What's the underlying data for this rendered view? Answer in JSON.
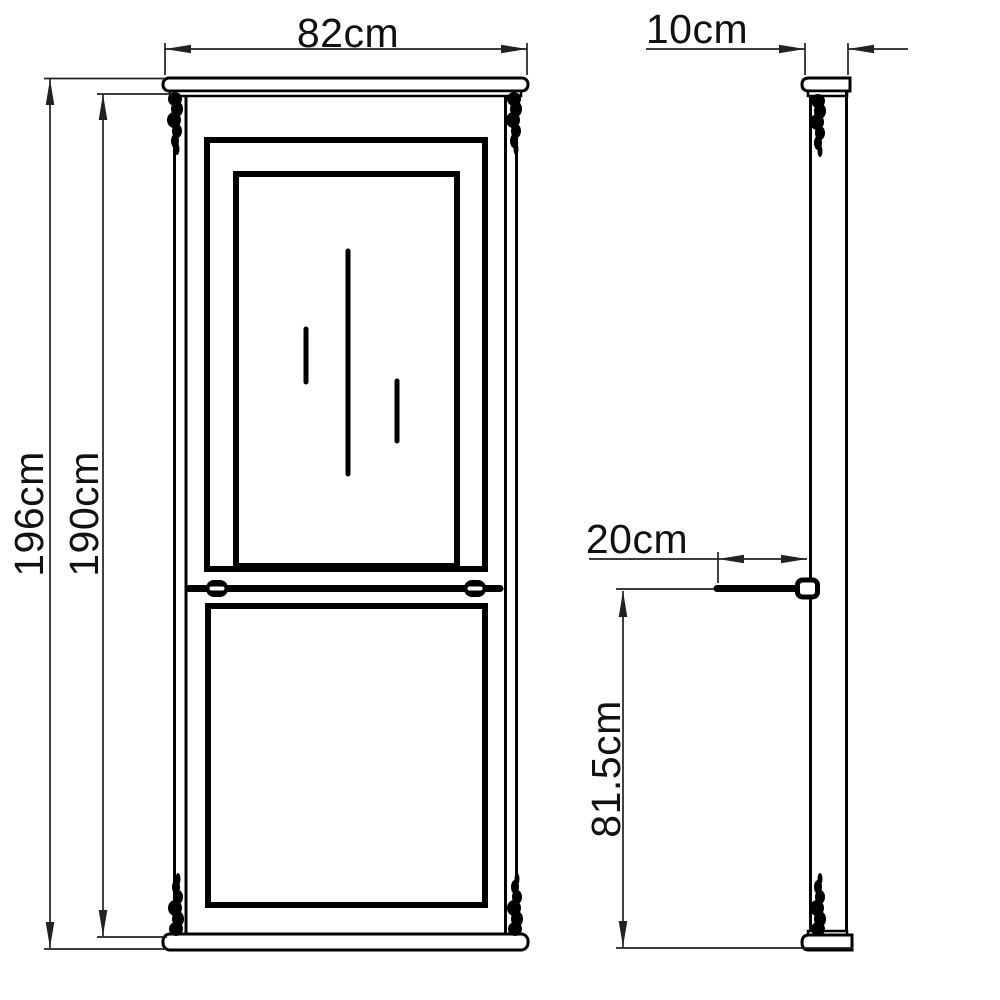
{
  "labels": {
    "width": "82cm",
    "total_height": "196cm",
    "body_height": "190cm",
    "depth": "10cm",
    "shelf_depth": "20cm",
    "shelf_height": "81.5cm"
  },
  "colors": {
    "background": "#ffffff",
    "outline": "#000000",
    "dimension_line": "#222222",
    "text": "#111111"
  }
}
